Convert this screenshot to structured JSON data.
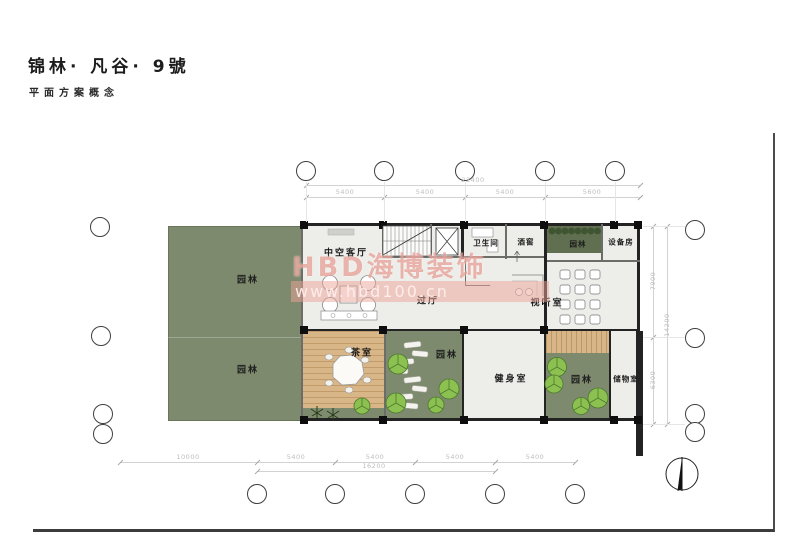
{
  "header": {
    "title": "锦林· 凡谷· 9號",
    "subtitle": "平面方案概念"
  },
  "watermark": {
    "line1": "HBD海博装饰",
    "line2": "www.hbd100.cn",
    "pink": "#e8988e"
  },
  "rooms": [
    {
      "id": "garden-left-top",
      "label": "园林"
    },
    {
      "id": "garden-left-bottom",
      "label": "园林"
    },
    {
      "id": "living-room",
      "label": "中空客厅"
    },
    {
      "id": "hallway",
      "label": "过厅"
    },
    {
      "id": "bathroom",
      "label": "卫生间"
    },
    {
      "id": "wine-cellar",
      "label": "酒窖"
    },
    {
      "id": "garden-hedge",
      "label": "园林"
    },
    {
      "id": "equipment-room",
      "label": "设备房"
    },
    {
      "id": "av-room",
      "label": "视听室"
    },
    {
      "id": "tea-room",
      "label": "茶室"
    },
    {
      "id": "garden-middle",
      "label": "园林"
    },
    {
      "id": "gym",
      "label": "健身室"
    },
    {
      "id": "garden-right",
      "label": "园林"
    },
    {
      "id": "storage-room",
      "label": "储物室"
    }
  ],
  "dims": {
    "top": {
      "total": "22400",
      "segments": [
        "5400",
        "5400",
        "5400",
        "5600"
      ]
    },
    "right": {
      "total": "14200",
      "segments": [
        "7900",
        "6300"
      ]
    },
    "bottom": {
      "total": "16200",
      "segments": [
        "10000",
        "5400",
        "5400",
        "5400",
        "5400"
      ]
    }
  },
  "colors": {
    "garden_green": "#7e8a6e",
    "hedge_green": "#5f6f4f",
    "wood": "#d9b687",
    "floor": "#ededea",
    "wall": "#232323",
    "tree_green": "#8cc152",
    "watermark_pink": "#e8988e"
  }
}
